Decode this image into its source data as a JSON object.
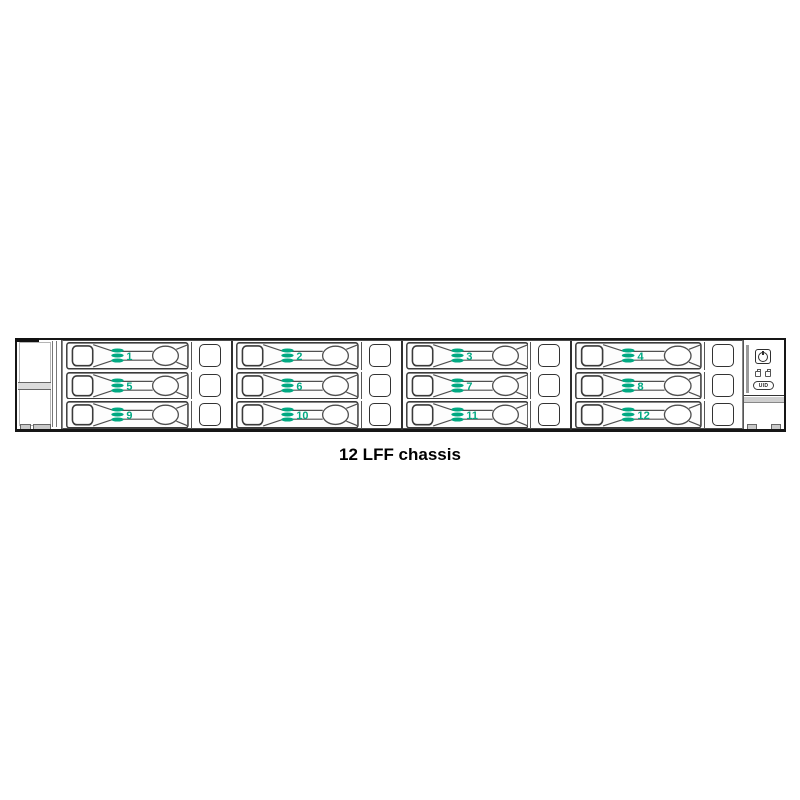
{
  "caption": "12 LFF chassis",
  "colors": {
    "green": "#01A982"
  },
  "chassis": {
    "bays": [
      {
        "label": "1"
      },
      {
        "label": "2"
      },
      {
        "label": "3"
      },
      {
        "label": "4"
      },
      {
        "label": "5"
      },
      {
        "label": "6"
      },
      {
        "label": "7"
      },
      {
        "label": "8"
      },
      {
        "label": "9"
      },
      {
        "label": "10"
      },
      {
        "label": "11"
      },
      {
        "label": "12"
      }
    ],
    "right_ear": {
      "uid_label": "UID"
    }
  }
}
